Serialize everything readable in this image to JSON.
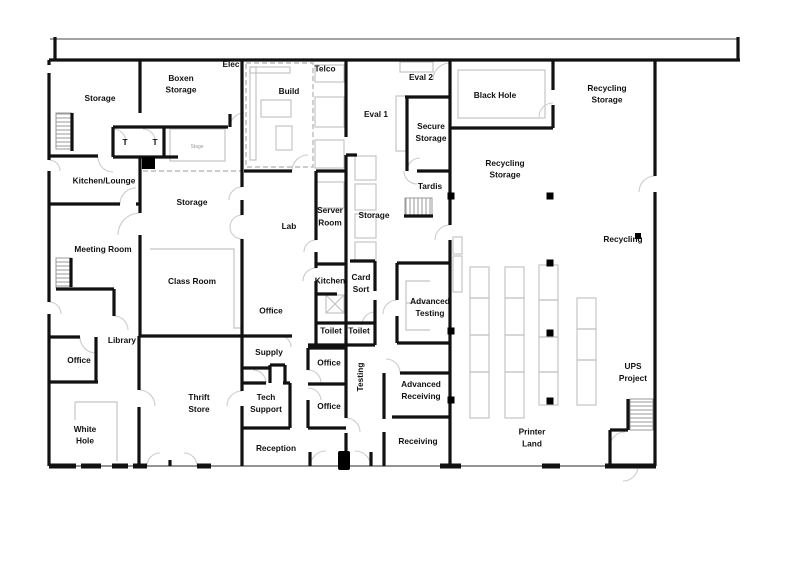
{
  "colors": {
    "wall": "#111111",
    "furniture": "#c4c4c4",
    "door_arc": "#cccccc",
    "column": "#000000",
    "dashed": "#bbbbbb"
  },
  "labels": {
    "storage_tl": {
      "text": "Storage"
    },
    "boxen": {
      "l1": "Boxen",
      "l2": "Storage"
    },
    "elec": {
      "text": "Elec"
    },
    "build": {
      "text": "Build"
    },
    "telco": {
      "text": "Telco"
    },
    "eval2": {
      "text": "Eval 2"
    },
    "eval1": {
      "text": "Eval 1"
    },
    "black_hole": {
      "text": "Black Hole"
    },
    "recycling_tr": {
      "l1": "Recycling",
      "l2": "Storage"
    },
    "secure": {
      "l1": "Secure",
      "l2": "Storage"
    },
    "kitchen_lounge": {
      "text": "Kitchen/Lounge"
    },
    "tardis": {
      "text": "Tardis"
    },
    "recycling_mid": {
      "l1": "Recycling",
      "l2": "Storage"
    },
    "storage_ml": {
      "text": "Storage"
    },
    "meeting_room": {
      "text": "Meeting Room"
    },
    "lab": {
      "text": "Lab"
    },
    "server_room": {
      "l1": "Server",
      "l2": "Room"
    },
    "storage_c": {
      "text": "Storage"
    },
    "recycling": {
      "text": "Recycling"
    },
    "class_room": {
      "text": "Class Room"
    },
    "kitchen": {
      "text": "Kitchen"
    },
    "card_sort": {
      "l1": "Card",
      "l2": "Sort"
    },
    "adv_testing": {
      "l1": "Advanced",
      "l2": "Testing"
    },
    "office1": {
      "text": "Office"
    },
    "toilet1": {
      "text": "Toilet"
    },
    "toilet2": {
      "text": "Toilet"
    },
    "library": {
      "text": "Library"
    },
    "supply": {
      "text": "Supply"
    },
    "office2": {
      "text": "Office"
    },
    "testing": {
      "text": "Testing"
    },
    "office_left": {
      "text": "Office"
    },
    "adv_receiving": {
      "l1": "Advanced",
      "l2": "Receiving"
    },
    "ups": {
      "l1": "UPS",
      "l2": "Project"
    },
    "thrift": {
      "l1": "Thrift",
      "l2": "Store"
    },
    "tech_support": {
      "l1": "Tech",
      "l2": "Support"
    },
    "office3": {
      "text": "Office"
    },
    "white_hole": {
      "l1": "White",
      "l2": "Hole"
    },
    "receiving": {
      "text": "Receiving"
    },
    "printer_land": {
      "l1": "Printer",
      "l2": "Land"
    },
    "reception": {
      "text": "Reception"
    },
    "t1": {
      "text": "T"
    },
    "t2": {
      "text": "T"
    },
    "stage": {
      "text": "Stage"
    }
  }
}
